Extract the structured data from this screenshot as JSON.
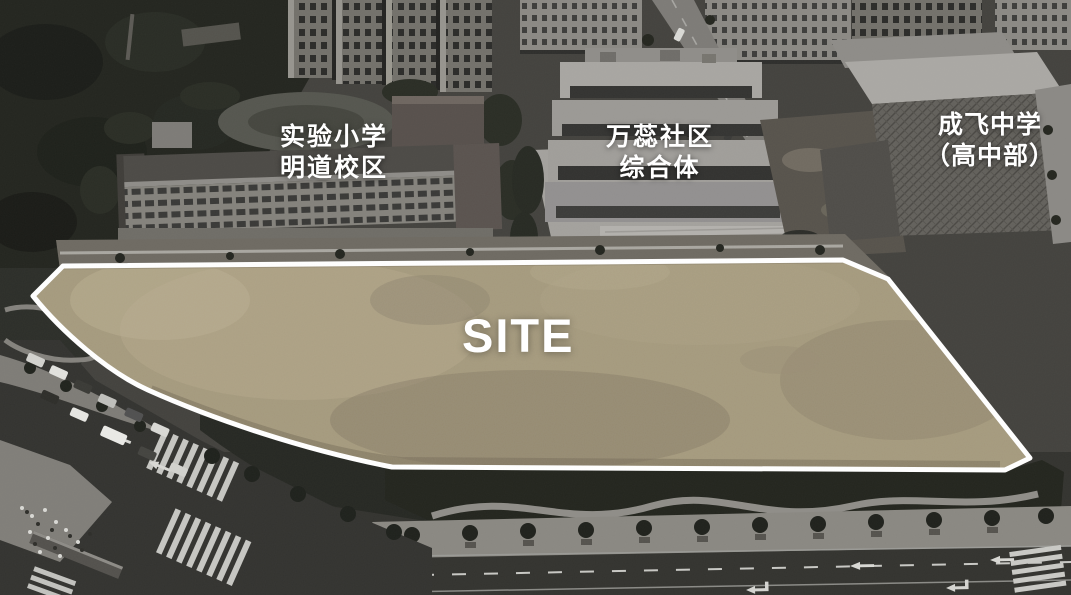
{
  "annotations": {
    "primary_school": {
      "line1": "实验小学",
      "line2": "明道校区"
    },
    "community_complex": {
      "line1": "万蕊社区",
      "line2": "综合体"
    },
    "high_school": {
      "line1": "成飞中学",
      "line2": "（高中部）"
    },
    "site_label": "SITE"
  },
  "colors": {
    "site_fill": "#a59a7d",
    "site_outline": "#ffffff",
    "annotation_text": "#ffffff"
  }
}
